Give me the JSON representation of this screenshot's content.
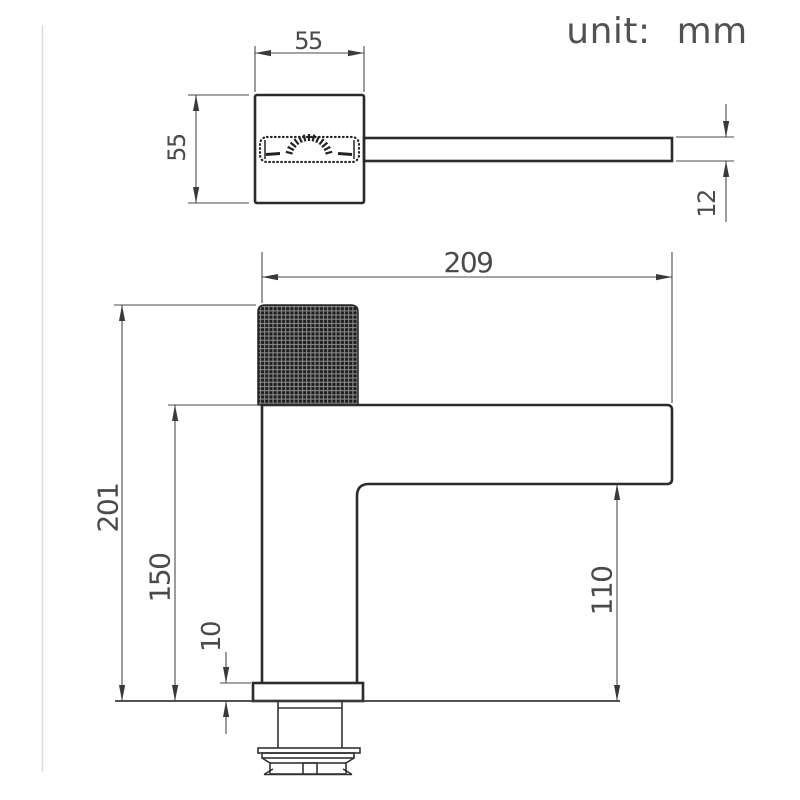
{
  "unit_label": "unit: mm",
  "top_view": {
    "body_width_mm": "55",
    "body_depth_mm": "55",
    "spout_thickness_mm": "12"
  },
  "front_view": {
    "spout_reach_mm": "209",
    "total_height_mm": "201",
    "spout_height_mm": "150",
    "base_plate_height_mm": "10",
    "spout_clearance_mm": "110"
  }
}
